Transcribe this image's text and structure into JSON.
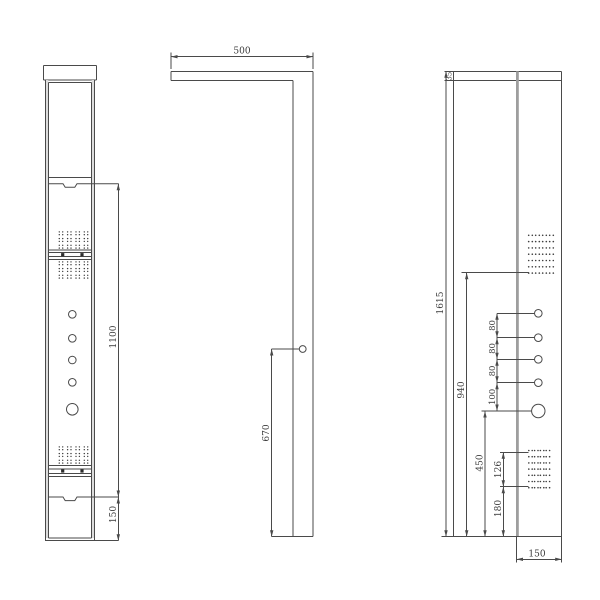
{
  "colors": {
    "line": "#4a4a4a",
    "text": "#3a3a3a",
    "background": "#ffffff",
    "panel_edge_fill": "#dcdcdc",
    "divider_fill": "#9e9e9e"
  },
  "views": {
    "front": {
      "dims": {
        "panel_mid": "1100",
        "base": "150"
      }
    },
    "side": {
      "dims": {
        "top_arm": "500",
        "outlet": "670"
      }
    },
    "detail": {
      "dims": {
        "cap": "35",
        "total": "1615",
        "jets": "940",
        "knob": "450",
        "spray": "126",
        "spray_bottom": "180",
        "width": "150",
        "gap_1": "80",
        "gap_2": "80",
        "gap_3": "80",
        "gap_4": "100"
      }
    }
  }
}
